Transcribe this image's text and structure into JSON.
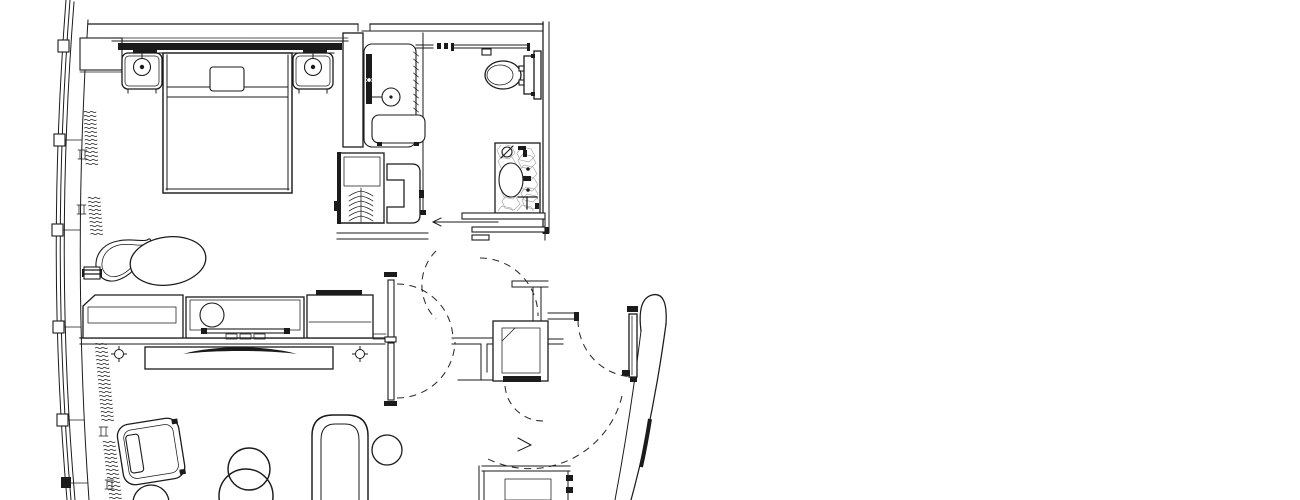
{
  "document": {
    "kind": "architectural floor plan",
    "subject": "Hotel guest room suite floor plan, black line drawing on white",
    "visible_text": [],
    "style": "CAD linework, dashed door-swing arcs, marble-hatched vanity"
  },
  "colors": {
    "background": "#ffffff",
    "line": "#1b1b1b",
    "marble_hatch": "#a8a8a8"
  },
  "legend": {
    "exterior": [
      "curved curtain-wall window",
      "window mullions",
      "drapery squiggles"
    ],
    "rooms": [
      {
        "name": "bedroom",
        "fixtures": [
          "king bed",
          "headboard",
          "pillow",
          "nightstand left",
          "nightstand right",
          "table lamp left",
          "table lamp right",
          "swivel chair",
          "ottoman",
          "wall vent block"
        ]
      },
      {
        "name": "shower room",
        "fixtures": [
          "walk-in shower stall",
          "shower head",
          "shower control bar",
          "shower bench",
          "glass panel",
          "towel bar",
          "robe hooks"
        ]
      },
      {
        "name": "closet",
        "fixtures": [
          "closet shelf",
          "hanging rod with hangers",
          "closet door panel",
          "luggage rack"
        ]
      },
      {
        "name": "bathroom",
        "fixtures": [
          "toilet",
          "toilet tank",
          "vanity counter",
          "sink basin",
          "faucet",
          "towel ring",
          "towel bar",
          "sliding pocket door with direction arrow"
        ]
      },
      {
        "name": "living area",
        "fixtures": [
          "desk",
          "minibar cabinet",
          "ice bucket",
          "bottle tray",
          "storage cabinet",
          "tv console",
          "flat screen tv",
          "floor outlet left",
          "floor outlet right",
          "armchair",
          "side table",
          "round lounge chair",
          "curved lounge chair",
          "chaise side table"
        ]
      },
      {
        "name": "entry vestibule",
        "fixtures": [
          "double connecting door",
          "door swing arcs",
          "service shaft",
          "entry door",
          "threshold bar"
        ]
      },
      {
        "name": "corridor",
        "fixtures": [
          "curved corridor wall",
          "wall end bullnose",
          "neighbor cabinet"
        ]
      }
    ]
  }
}
